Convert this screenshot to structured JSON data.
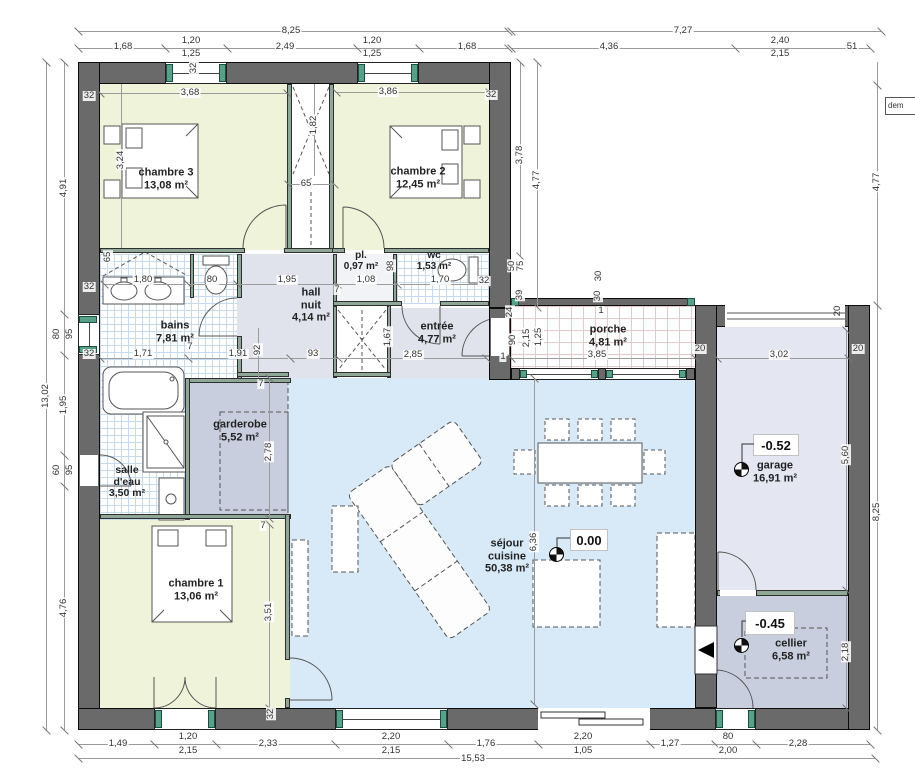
{
  "rooms": {
    "chambre3": {
      "name": "chambre 3",
      "area": "13,08 m²"
    },
    "chambre2": {
      "name": "chambre 2",
      "area": "12,45 m²"
    },
    "chambre1": {
      "name": "chambre 1",
      "area": "13,06 m²"
    },
    "bains": {
      "name": "bains",
      "area": "7,81 m²"
    },
    "pl": {
      "name": "pl.",
      "area": "0,97 m²"
    },
    "wc": {
      "name": "wc",
      "area": "1,53 m²"
    },
    "hall_nuit": {
      "line1": "hall",
      "line2": "nuit",
      "area": "4,14 m²"
    },
    "entree": {
      "name": "entrée",
      "area": "4,77 m²"
    },
    "porche": {
      "name": "porche",
      "area": "4,81 m²"
    },
    "garderobe": {
      "name": "garderobe",
      "area": "5,52 m²"
    },
    "salle_eau": {
      "line1": "salle",
      "line2": "d'eau",
      "area": "3,50 m²"
    },
    "sejour": {
      "line1": "séjour",
      "line2": "cuisine",
      "area": "50,38 m²"
    },
    "garage": {
      "name": "garage",
      "area": "16,91 m²"
    },
    "cellier": {
      "name": "cellier",
      "area": "6,58 m²"
    }
  },
  "levels": {
    "sejour": "0.00",
    "garage": "-0.52",
    "cellier": "-0.45"
  },
  "note": {
    "dem": "dem"
  },
  "dim_labels": [
    [
      "8,25",
      291,
      31,
      0
    ],
    [
      "7,27",
      683,
      31,
      0
    ],
    [
      "1,68",
      123,
      47,
      0
    ],
    [
      "1,20",
      191,
      41,
      0
    ],
    [
      "1,25",
      191,
      54,
      0
    ],
    [
      "2,49",
      285,
      47,
      0
    ],
    [
      "1,20",
      372,
      41,
      0
    ],
    [
      "1,25",
      372,
      54,
      0
    ],
    [
      "1,68",
      467,
      47,
      0
    ],
    [
      "4,36",
      609,
      47,
      0
    ],
    [
      "2,40",
      780,
      41,
      0
    ],
    [
      "2,15",
      780,
      54,
      0
    ],
    [
      "51",
      852,
      47,
      0
    ],
    [
      "1,49",
      118,
      744,
      0
    ],
    [
      "1,20",
      188,
      737,
      0
    ],
    [
      "2,15",
      188,
      751,
      0
    ],
    [
      "2,33",
      268,
      744,
      0
    ],
    [
      "2,20",
      391,
      737,
      0
    ],
    [
      "2,15",
      391,
      751,
      0
    ],
    [
      "1,76",
      486,
      744,
      0
    ],
    [
      "2,20",
      583,
      737,
      0
    ],
    [
      "1,05",
      583,
      751,
      0
    ],
    [
      "1,27",
      670,
      744,
      0
    ],
    [
      "80",
      728,
      737,
      0
    ],
    [
      "2,00",
      728,
      751,
      0
    ],
    [
      "2,28",
      798,
      744,
      0
    ],
    [
      "15,53",
      473,
      759,
      0
    ],
    [
      "4,91",
      64,
      188,
      1
    ],
    [
      "80",
      57,
      334,
      1
    ],
    [
      "95",
      70,
      334,
      1
    ],
    [
      "1,95",
      64,
      405,
      1
    ],
    [
      "60",
      57,
      470,
      1
    ],
    [
      "95",
      70,
      470,
      1
    ],
    [
      "4,76",
      64,
      608,
      1
    ],
    [
      "13,02",
      46,
      396,
      1
    ],
    [
      "3,78",
      520,
      155,
      1
    ],
    [
      "4,77",
      537,
      180,
      1
    ],
    [
      "4,77",
      877,
      182,
      1
    ],
    [
      "8,25",
      877,
      512,
      1
    ],
    [
      "5,60",
      846,
      455,
      1
    ],
    [
      "2,18",
      846,
      652,
      1
    ],
    [
      "3,68",
      190,
      93,
      0
    ],
    [
      "3,86",
      388,
      92,
      0
    ],
    [
      "1,82",
      314,
      125,
      1
    ],
    [
      "65",
      306,
      184,
      0
    ],
    [
      "3,24",
      121,
      160,
      1
    ],
    [
      "32",
      89,
      96,
      0
    ],
    [
      "32",
      194,
      68,
      1
    ],
    [
      "32",
      491,
      95,
      0
    ],
    [
      "1,80",
      143,
      280,
      0
    ],
    [
      "80",
      212,
      280,
      0
    ],
    [
      "1,95",
      287,
      280,
      0
    ],
    [
      "65",
      108,
      257,
      1
    ],
    [
      "32",
      89,
      287,
      0
    ],
    [
      "1,08",
      366,
      280,
      0
    ],
    [
      "98",
      391,
      266,
      1
    ],
    [
      "1,70",
      440,
      280,
      0
    ],
    [
      "32",
      484,
      281,
      0
    ],
    [
      "1,71",
      143,
      354,
      0
    ],
    [
      "1,91",
      238,
      354,
      0
    ],
    [
      "92",
      258,
      350,
      1
    ],
    [
      "7",
      190,
      347,
      0
    ],
    [
      "32",
      89,
      354,
      0
    ],
    [
      "93",
      313,
      354,
      0
    ],
    [
      "2,85",
      413,
      355,
      0
    ],
    [
      "1,67",
      388,
      337,
      1
    ],
    [
      "7",
      337,
      290,
      0
    ],
    [
      "50",
      512,
      266,
      1
    ],
    [
      "75",
      521,
      266,
      1
    ],
    [
      "39",
      520,
      295,
      1
    ],
    [
      "24",
      510,
      312,
      1
    ],
    [
      "90",
      513,
      340,
      1
    ],
    [
      "2,15",
      527,
      338,
      1
    ],
    [
      "1,25",
      539,
      337,
      1
    ],
    [
      "1",
      503,
      357,
      0
    ],
    [
      "30",
      599,
      276,
      1
    ],
    [
      "30",
      598,
      296,
      1
    ],
    [
      "1",
      601,
      311,
      0
    ],
    [
      "3,85",
      597,
      355,
      0
    ],
    [
      "3,02",
      779,
      355,
      0
    ],
    [
      "20",
      700,
      349,
      0
    ],
    [
      "20",
      858,
      349,
      0
    ],
    [
      "20",
      838,
      311,
      1
    ],
    [
      "6,36",
      534,
      542,
      1
    ],
    [
      "2,78",
      269,
      452,
      1
    ],
    [
      "3,51",
      269,
      612,
      1
    ],
    [
      "7",
      261,
      384,
      0
    ],
    [
      "7",
      263,
      526,
      0
    ],
    [
      "32",
      271,
      714,
      1
    ]
  ]
}
